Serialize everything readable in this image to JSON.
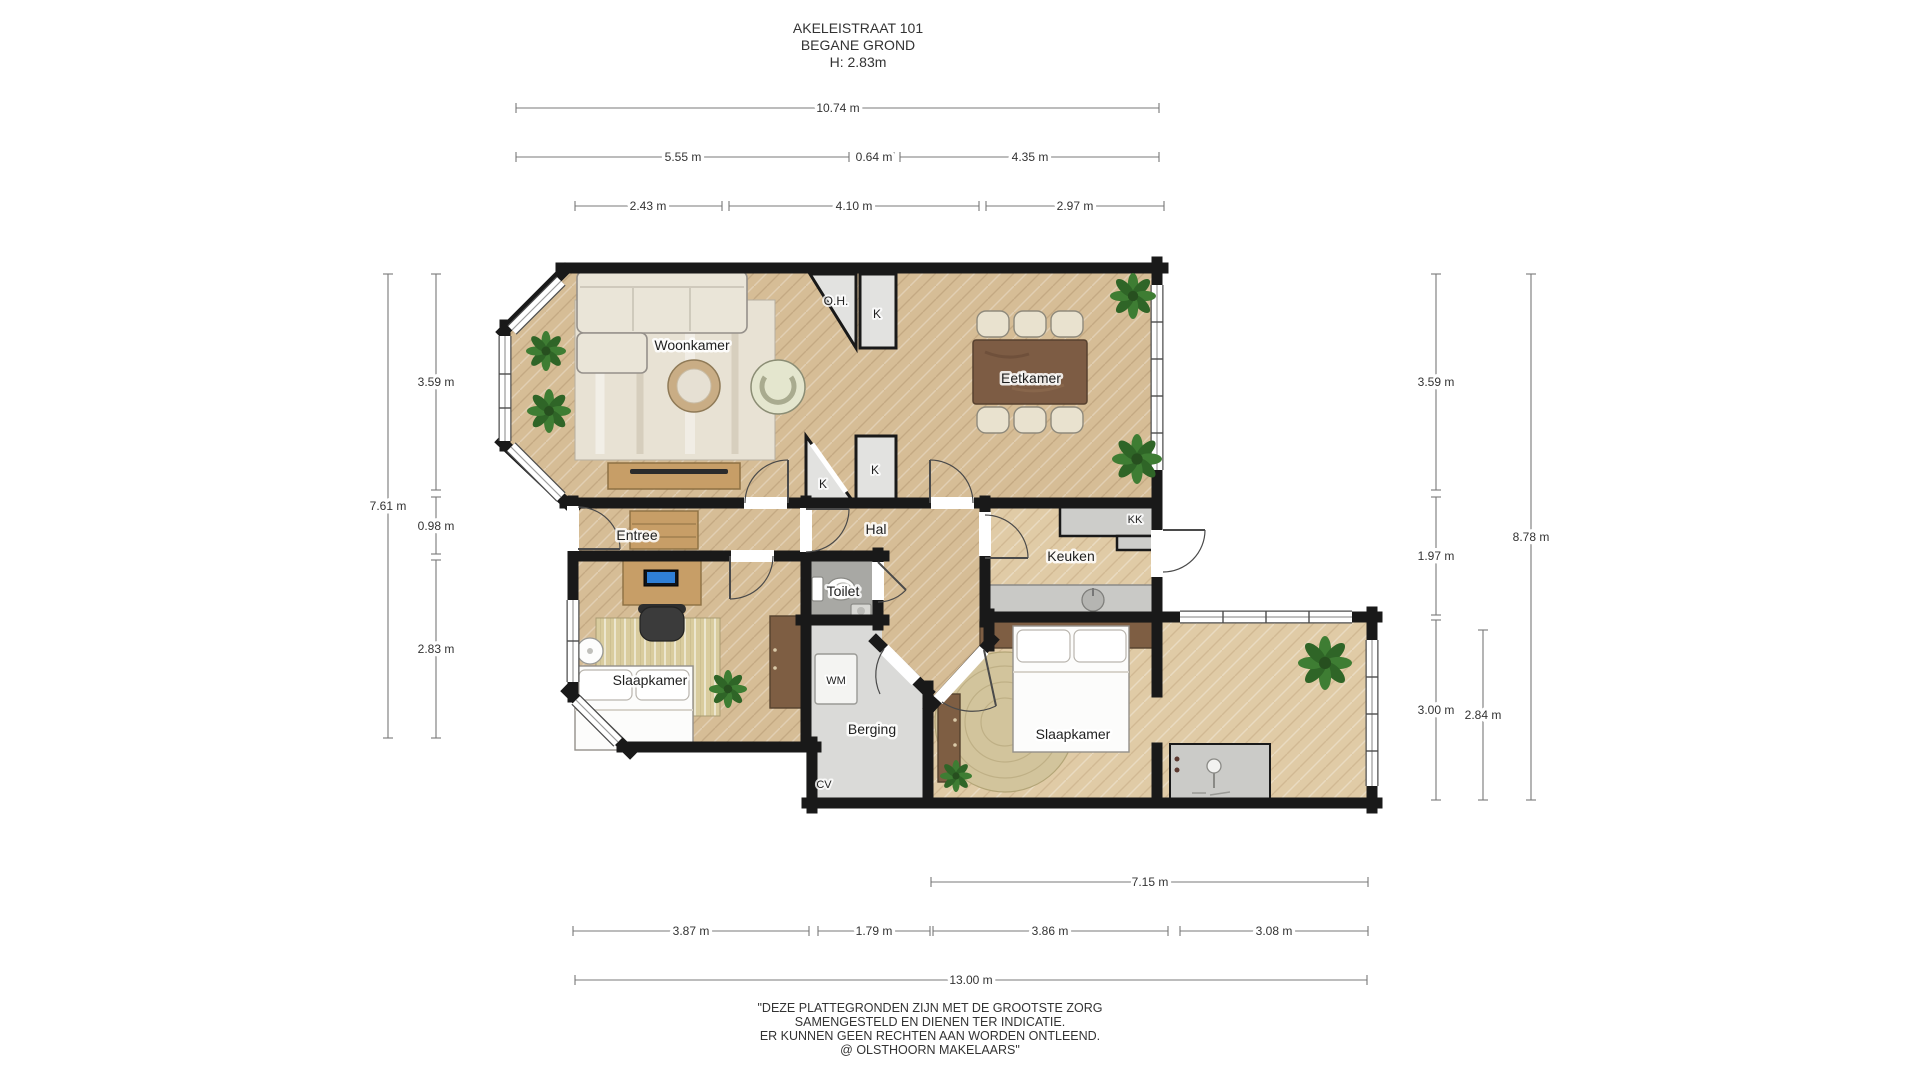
{
  "title": {
    "address": "AKELEISTRAAT 101",
    "floor": "BEGANE GROND",
    "height": "H: 2.83m"
  },
  "rooms": {
    "woonkamer": "Woonkamer",
    "eetkamer": "Eetkamer",
    "entree": "Entree",
    "hal": "Hal",
    "keuken": "Keuken",
    "toilet": "Toilet",
    "slaapkamer_left": "Slaapkamer",
    "slaapkamer_right": "Slaapkamer",
    "berging": "Berging"
  },
  "fixtures": {
    "open_haard": "O.H.",
    "closet_top": "K",
    "closet_mid_left": "K",
    "closet_mid_right": "K",
    "koelkast": "KK",
    "wasmachine": "WM",
    "cv_ketel": "CV"
  },
  "dimensions": {
    "top": {
      "total": "10.74 m",
      "row2": [
        "5.55 m",
        "0.64 m",
        "4.35 m"
      ],
      "row3": [
        "2.43 m",
        "4.10 m",
        "2.97 m"
      ]
    },
    "left": {
      "total": "7.61 m",
      "segments": [
        "3.59 m",
        "0.98 m",
        "2.83 m"
      ]
    },
    "right": {
      "total": "8.78 m",
      "segments": [
        "3.59 m",
        "1.97 m",
        "3.00 m"
      ],
      "wing": "2.84 m"
    },
    "bottom": {
      "wing_total": "7.15 m",
      "row2": [
        "3.87 m",
        "1.79 m",
        "3.86 m",
        "3.08 m"
      ],
      "total": "13.00 m"
    }
  },
  "disclaimer": [
    "\"DEZE PLATTEGRONDEN ZIJN MET DE GROOTSTE ZORG",
    "SAMENGESTELD EN DIENEN TER INDICATIE.",
    "ER KUNNEN GEEN RECHTEN AAN WORDEN ONTLEEND.",
    "@ OLSTHOORN MAKELAARS\""
  ],
  "colors": {
    "wall": "#191919",
    "floor_wood": "#d6bd96",
    "floor_wood_light": "#e0cba6",
    "floor_toilet": "#a8a8a4",
    "floor_storage": "#dadad8",
    "closet_gray": "#e2e2e0",
    "plant_green": "#3e7d33",
    "dim_line": "#787878",
    "dim_text": "#333333"
  }
}
